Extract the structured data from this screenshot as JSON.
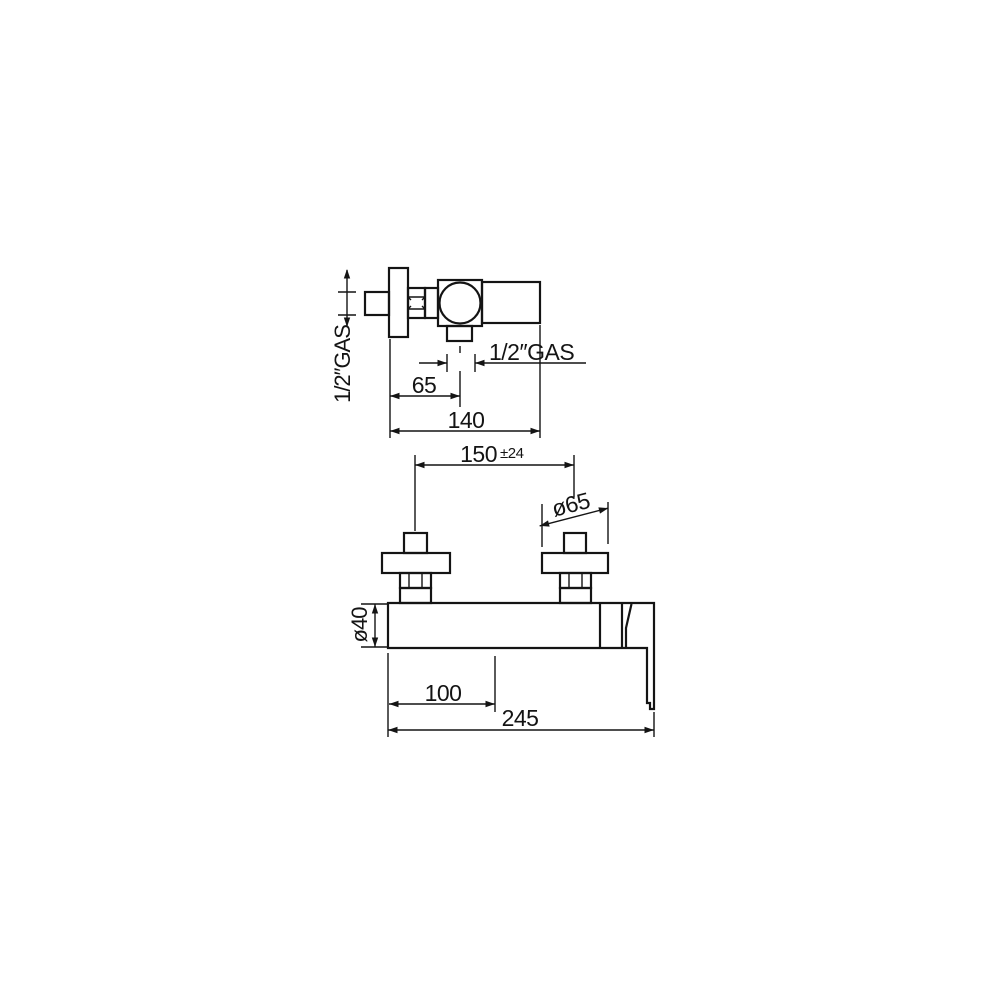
{
  "colors": {
    "line": "#141414",
    "background": "#ffffff"
  },
  "top_view": {
    "wall_connection_label": "1/2″GAS",
    "outlet_connection_label": "1/2″GAS",
    "dims": {
      "outlet_offset": "65",
      "depth": "140"
    }
  },
  "front_view": {
    "dims": {
      "hole_centers": "150",
      "hole_centers_tolerance": "±24",
      "flange_diameter": "ø65",
      "body_diameter": "ø40",
      "outlet_offset": "100",
      "overall_width": "245"
    }
  }
}
